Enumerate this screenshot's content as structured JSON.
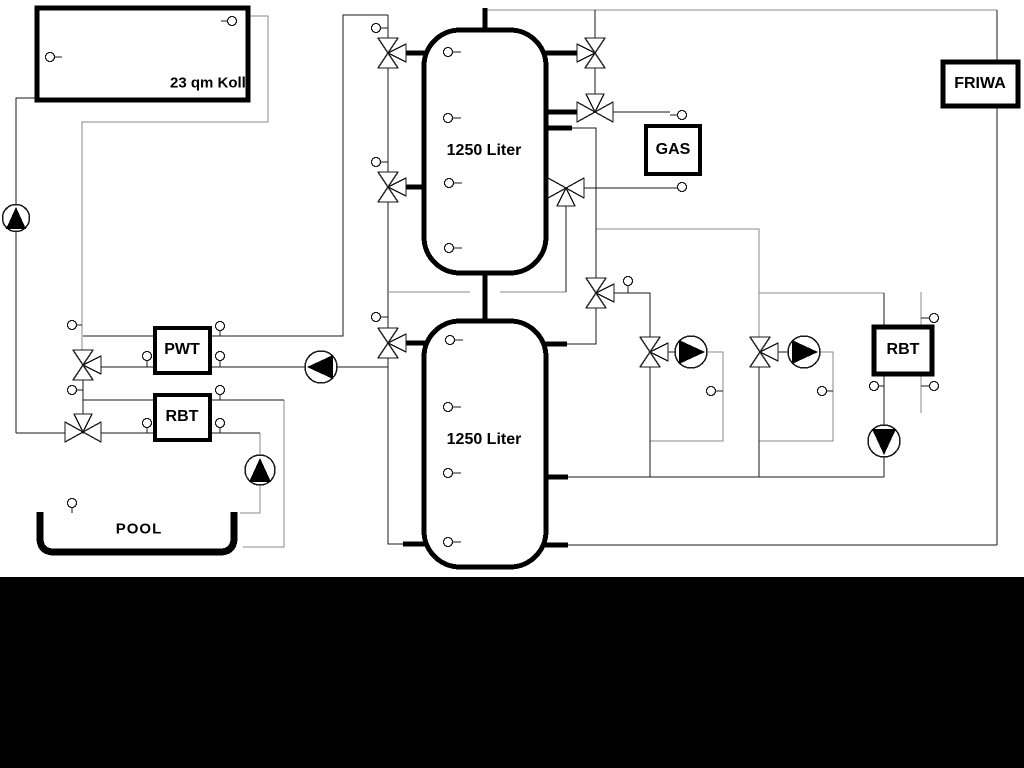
{
  "title": "Hydraulic heating schematic",
  "labels": {
    "collector": "23 qm Kolli",
    "tank1": "1250 Liter",
    "tank2": "1250 Liter",
    "pwt": "PWT",
    "rbt_left": "RBT",
    "rbt_right": "RBT",
    "gas": "GAS",
    "friwa": "FRIWA",
    "pool": "POOL"
  },
  "colors": {
    "pipe_black": "#1a1a1a",
    "pipe_gray": "#8a8a8a",
    "component_border": "#000000",
    "background": "#ffffff",
    "letterbox_band": "#000000"
  },
  "legend": {
    "pump_symbol": "circle with solid triangle",
    "valve_symbol": "three-way bowtie valve",
    "sensor_symbol": "small circle with tail"
  }
}
